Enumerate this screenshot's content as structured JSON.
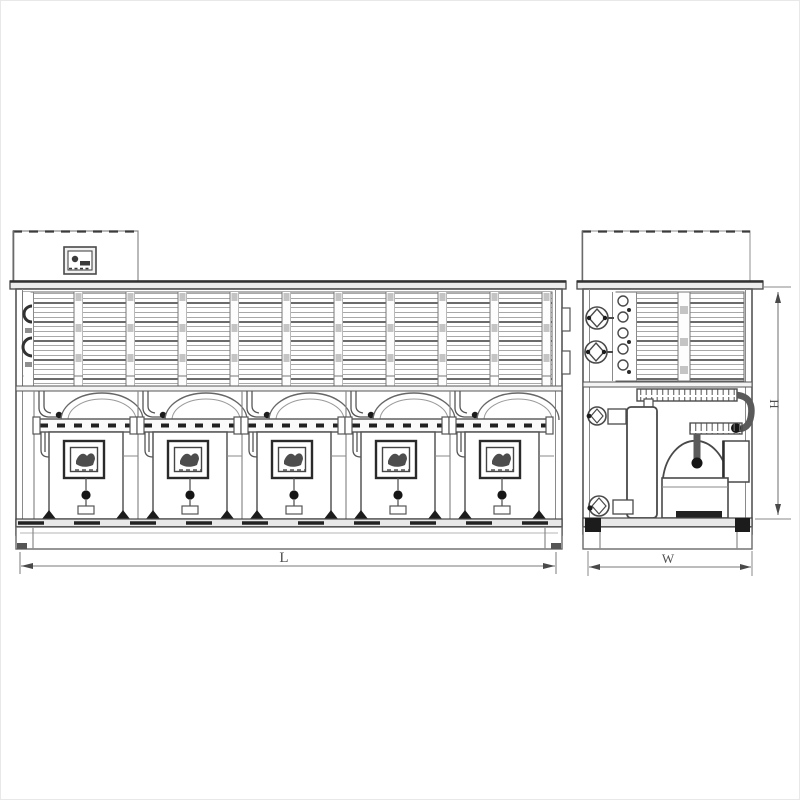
{
  "title": "Condensing unit technical drawing - front and side elevations",
  "colors": {
    "background": "#ffffff",
    "line": "#4a4a4a",
    "line_light": "#9a9a9a",
    "dark": "#1a1a1a",
    "fill": "#ffffff"
  },
  "views": {
    "front": {
      "name": "front-elevation",
      "compressor_count": 5,
      "dimension_label": "L"
    },
    "side": {
      "name": "side-elevation",
      "dimension_width_label": "W",
      "dimension_height_label": "H"
    }
  },
  "dimensions": {
    "length": "L",
    "width": "W",
    "height": "H"
  }
}
